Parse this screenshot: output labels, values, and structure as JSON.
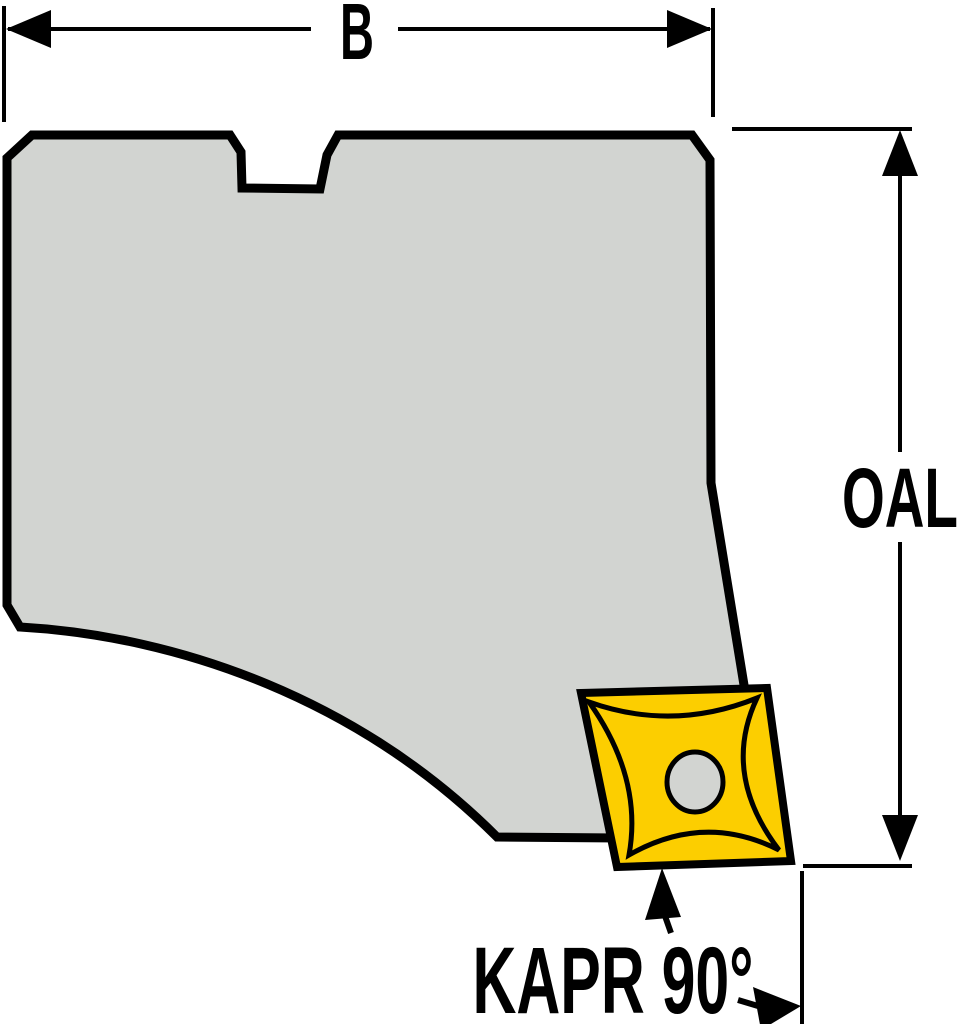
{
  "figure": {
    "type": "technical-drawing",
    "subject": "toolholder-cartridge-with-indexable-insert",
    "colors": {
      "background": "#ffffff",
      "outline": "#000000",
      "body_fill": "#d2d4d1",
      "insert_fill": "#fcce00",
      "hole_fill": "#d2d4d1",
      "dimension_lines": "#000000"
    },
    "dimensions": {
      "width_label": "B",
      "overall_length_label": "OAL",
      "approach_angle_label": "KAPR 90°"
    }
  }
}
